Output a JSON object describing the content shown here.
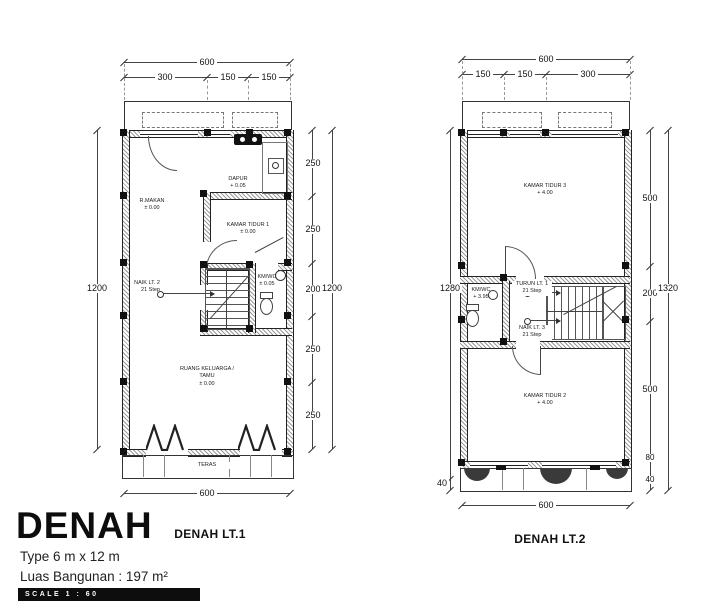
{
  "title_block": {
    "title": "DENAH",
    "type_line": "Type 6 m x 12 m",
    "area_line": "Luas Bangunan : 197 m²",
    "scale_label": "SCALE 1 : 60"
  },
  "plan1": {
    "caption": "DENAH LT.1",
    "dims": {
      "top_total": "600",
      "top_segments": [
        "300",
        "150",
        "150"
      ],
      "left_total": "1200",
      "right_segments": [
        "250",
        "250",
        "200",
        "250",
        "250"
      ],
      "right_total": "1200",
      "bottom_total": "600"
    },
    "rooms": {
      "dapur": {
        "name": "DAPUR",
        "level": "+ 0.05"
      },
      "rmakan": {
        "name": "R.MAKAN",
        "level": "± 0.00"
      },
      "kt1": {
        "name": "KAMAR TIDUR 1",
        "level": "± 0.00"
      },
      "kmwc": {
        "name": "KM/WC",
        "level": "± 0.05"
      },
      "keluarga": {
        "name": "RUANG KELUARGA / TAMU",
        "level": "± 0.00"
      },
      "teras": {
        "name": "TERAS"
      }
    },
    "stairs": {
      "up": {
        "name": "NAIK LT. 2",
        "steps": "21 Step"
      }
    }
  },
  "plan2": {
    "caption": "DENAH LT.2",
    "dims": {
      "top_total": "600",
      "top_segments": [
        "150",
        "150",
        "300"
      ],
      "left_total": "1280",
      "left_bottom": "40",
      "right_segments": [
        "500",
        "200",
        "500",
        "80",
        "40"
      ],
      "right_total": "1320",
      "bottom_total": "600"
    },
    "rooms": {
      "kt3": {
        "name": "KAMAR TIDUR 3",
        "level": "+ 4.00"
      },
      "kt2": {
        "name": "KAMAR TIDUR 2",
        "level": "+ 4.00"
      },
      "kmwc": {
        "name": "KM/WC",
        "level": "+ 3.95"
      }
    },
    "stairs": {
      "down": {
        "name": "TURUN LT. 1",
        "steps": "21 Step"
      },
      "up": {
        "name": "NAIK LT. 3",
        "steps": "21 Step"
      }
    }
  }
}
